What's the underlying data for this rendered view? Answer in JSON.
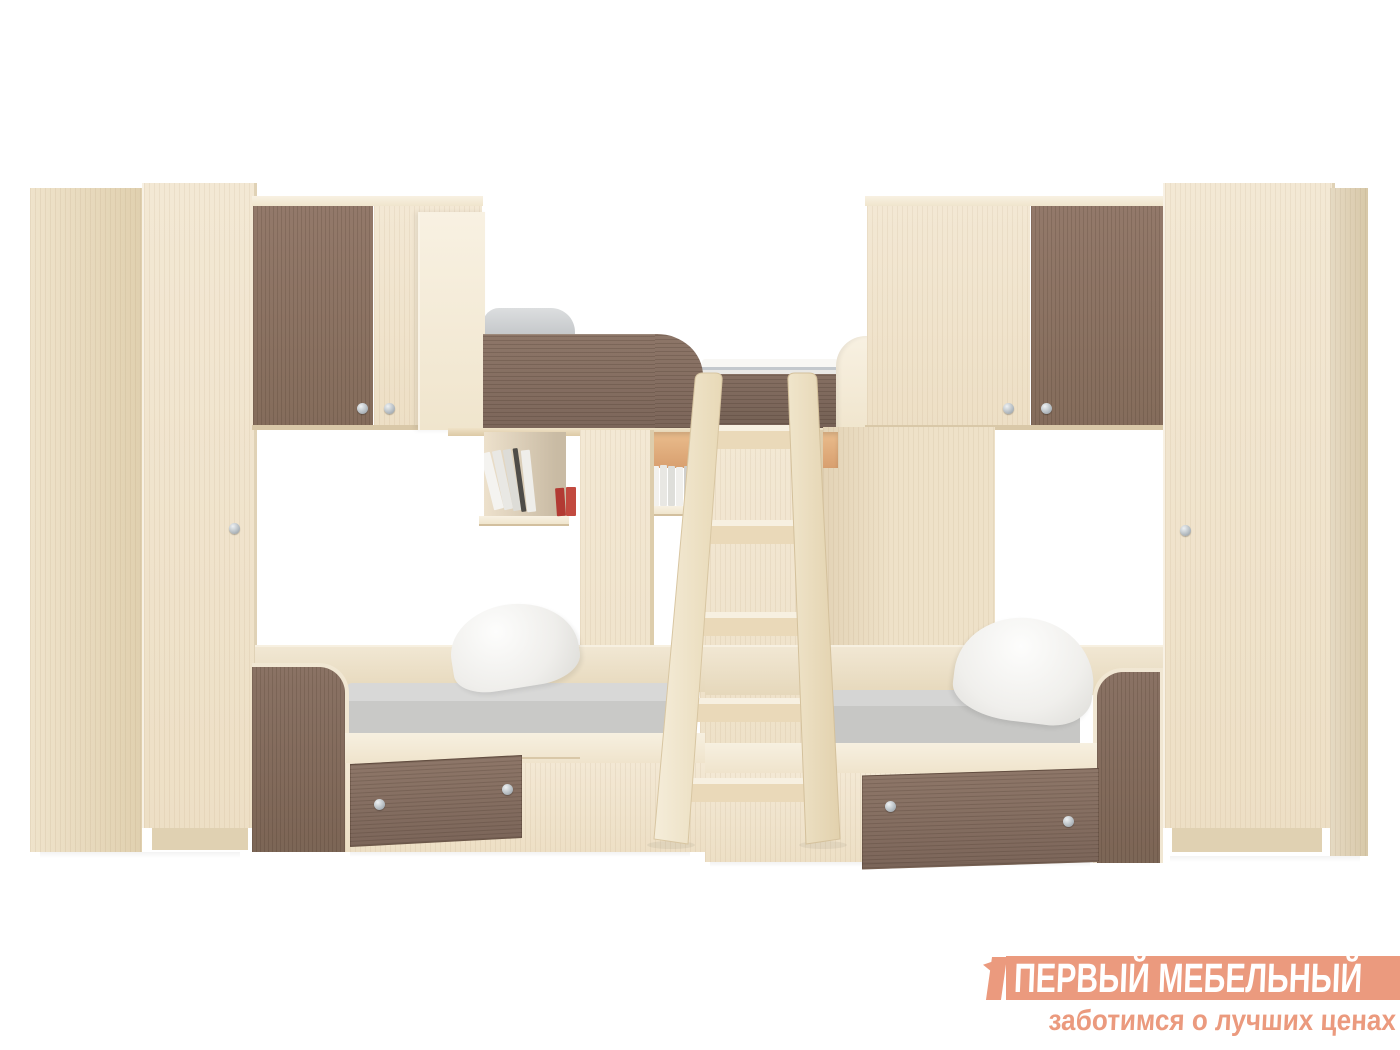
{
  "scene": {
    "subject": "corner-triple-bunk-bed-with-wardrobes-product-photo",
    "background_color": "#ffffff",
    "palette": {
      "light_wood": "#f0e4cd",
      "light_wood_shade": "#e0d0af",
      "light_wood_bright": "#f6eedd",
      "dark_wood": "#8a7261",
      "dark_wood_deep": "#7c665a",
      "mattress_gray": "#cfcfcf",
      "bed_linen_white": "#f4f3f0",
      "pillow_white": "#f6f5f2",
      "book_red": "#b23a33",
      "handle_silver": "#c3c9cd",
      "niche_amber": "#e0ab79"
    }
  },
  "watermark": {
    "brand": "ПЕРВЫЙ МЕБЕЛЬНЫЙ",
    "tagline": "заботимся о лучших ценах",
    "banner_color": "#eb9a7e",
    "brand_text_color": "#ffffff",
    "tagline_color": "#eb9a7e"
  }
}
